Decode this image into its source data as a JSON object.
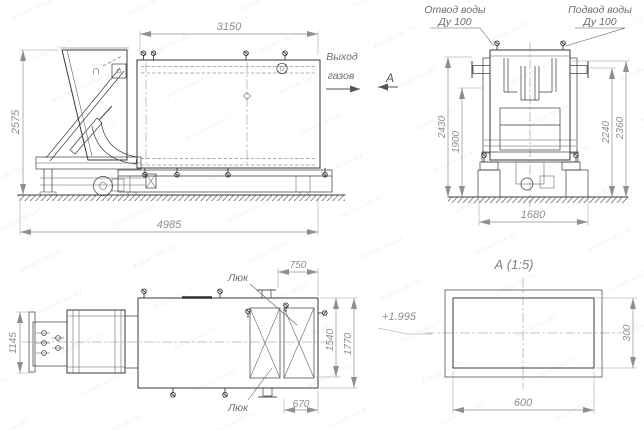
{
  "drawing": {
    "watermark_text": "kotlam-tec.kz",
    "front_view": {
      "dim_top": "3150",
      "dim_left": "2575",
      "dim_bottom": "4985",
      "gas_out_line1": "Выход",
      "gas_out_line2": "газов",
      "section_mark": "А",
      "hopper_mark": "∩"
    },
    "end_view": {
      "outlet_line1": "Отвод воды",
      "outlet_line2": "Ду 100",
      "inlet_line1": "Подвод воды",
      "inlet_line2": "Ду 100",
      "dim_h_2430": "2430",
      "dim_h_1900": "1900",
      "dim_h_2240": "2240",
      "dim_h_2360": "2360",
      "dim_base": "1680"
    },
    "plan_view": {
      "dim_left": "1145",
      "dim_top": "750",
      "dim_right_inner": "1540",
      "dim_right_outer": "1770",
      "dim_bottom": "670",
      "hatch_label_top": "Люк",
      "hatch_label_bottom": "Люк",
      "elevation_mark": "+1.995"
    },
    "section_view": {
      "title": "А (1:5)",
      "dim_width": "600",
      "dim_height": "300"
    }
  }
}
